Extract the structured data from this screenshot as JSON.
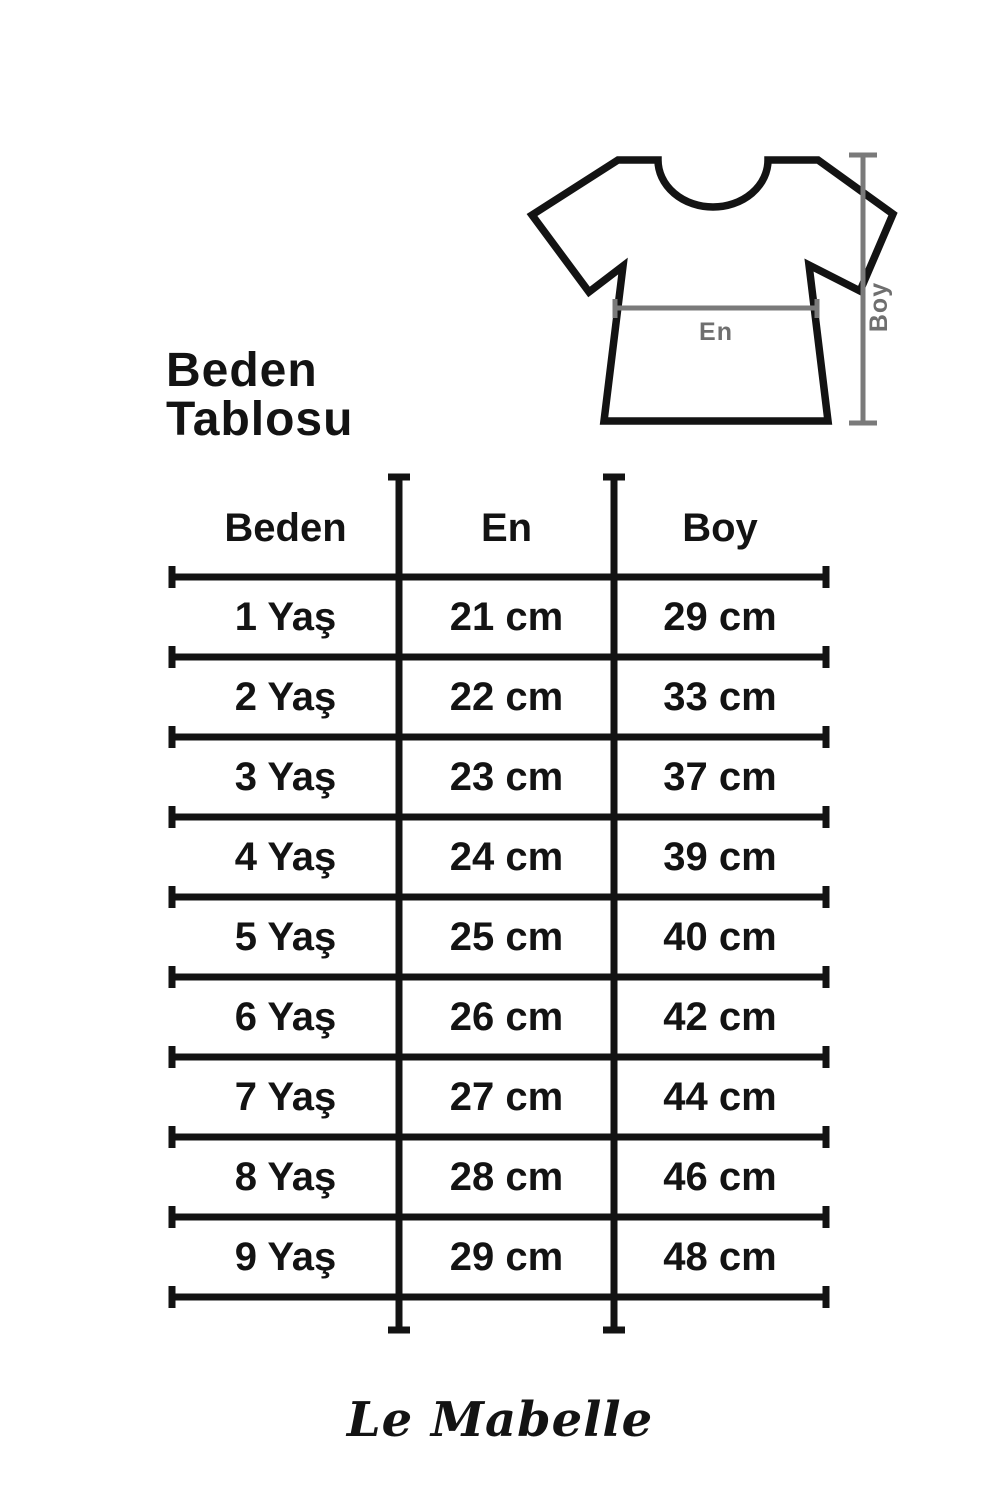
{
  "title": "Beden Tablosu",
  "diagram": {
    "width_label": "En",
    "height_label": "Boy"
  },
  "table": {
    "headers": {
      "size": "Beden",
      "width": "En",
      "height": "Boy"
    },
    "rows": [
      {
        "size": "1 Yaş",
        "en": "21 cm",
        "boy": "29 cm"
      },
      {
        "size": "2 Yaş",
        "en": "22 cm",
        "boy": "33 cm"
      },
      {
        "size": "3 Yaş",
        "en": "23 cm",
        "boy": "37 cm"
      },
      {
        "size": "4 Yaş",
        "en": "24 cm",
        "boy": "39 cm"
      },
      {
        "size": "5 Yaş",
        "en": "25 cm",
        "boy": "40 cm"
      },
      {
        "size": "6 Yaş",
        "en": "26 cm",
        "boy": "42 cm"
      },
      {
        "size": "7 Yaş",
        "en": "27 cm",
        "boy": "44 cm"
      },
      {
        "size": "8 Yaş",
        "en": "28 cm",
        "boy": "46 cm"
      },
      {
        "size": "9 Yaş",
        "en": "29 cm",
        "boy": "48 cm"
      }
    ]
  },
  "footer": {
    "brand": "Le Mabelle"
  },
  "colors": {
    "ink": "#131313",
    "measure_line": "#7a7a7a",
    "measure_text": "#6f6f6f",
    "background": "#ffffff"
  },
  "chart_data": {
    "type": "table",
    "title": "Beden Tablosu",
    "columns": [
      "Beden",
      "En",
      "Boy"
    ],
    "rows": [
      [
        "1 Yaş",
        "21 cm",
        "29 cm"
      ],
      [
        "2 Yaş",
        "22 cm",
        "33 cm"
      ],
      [
        "3 Yaş",
        "23 cm",
        "37 cm"
      ],
      [
        "4 Yaş",
        "24 cm",
        "39 cm"
      ],
      [
        "5 Yaş",
        "25 cm",
        "40 cm"
      ],
      [
        "6 Yaş",
        "26 cm",
        "42 cm"
      ],
      [
        "7 Yaş",
        "27 cm",
        "44 cm"
      ],
      [
        "8 Yaş",
        "28 cm",
        "46 cm"
      ],
      [
        "9 Yaş",
        "29 cm",
        "48 cm"
      ]
    ],
    "en_cm": [
      21,
      22,
      23,
      24,
      25,
      26,
      27,
      28,
      29
    ],
    "boy_cm": [
      29,
      33,
      37,
      39,
      40,
      42,
      44,
      46,
      48
    ]
  }
}
